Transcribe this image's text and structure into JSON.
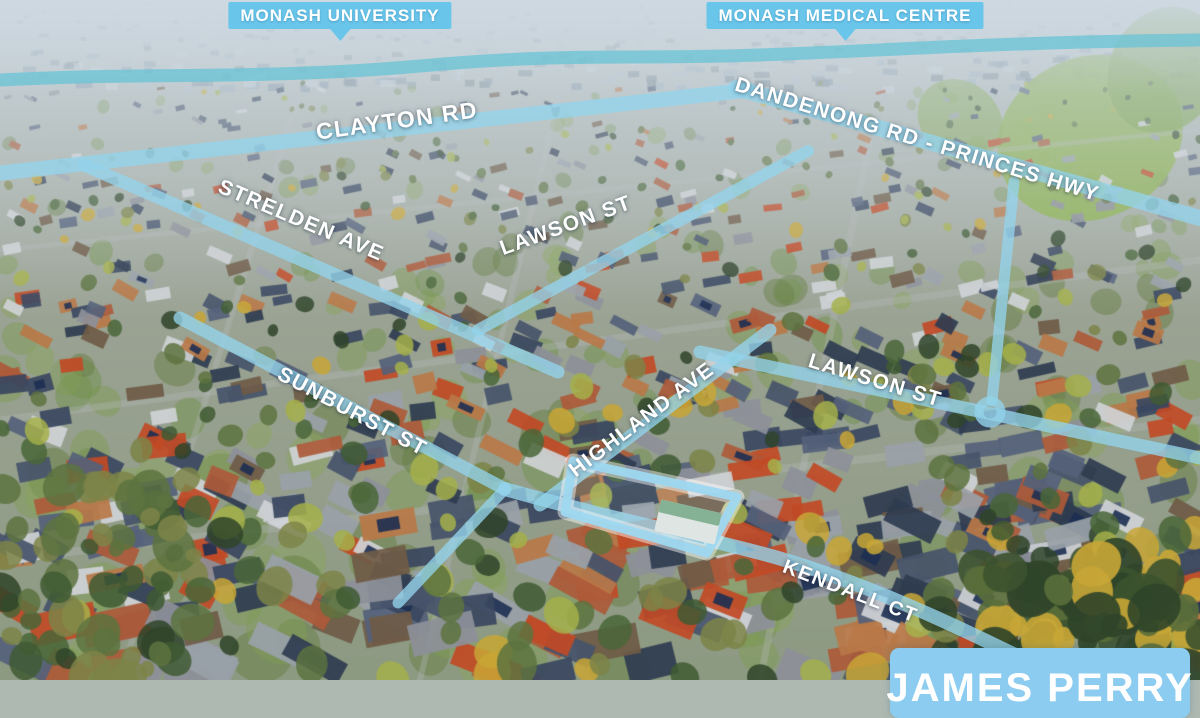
{
  "overlay": {
    "landmarks": [
      {
        "id": "monash-university",
        "label": "MONASH UNIVERSITY"
      },
      {
        "id": "monash-medical-centre",
        "label": "MONASH MEDICAL CENTRE"
      }
    ],
    "streets": [
      {
        "id": "clayton-rd",
        "label": "CLAYTON RD"
      },
      {
        "id": "dandenong-rd",
        "label": "DANDENONG RD - PRINCES HWY"
      },
      {
        "id": "strelden-ave",
        "label": "STRELDEN AVE"
      },
      {
        "id": "lawson-st-west",
        "label": "LAWSON ST"
      },
      {
        "id": "lawson-st-east",
        "label": "LAWSON ST"
      },
      {
        "id": "sunburst-st",
        "label": "SUNBURST ST"
      },
      {
        "id": "highland-ave",
        "label": "HIGHLAND AVE"
      },
      {
        "id": "kendall-ct",
        "label": "KENDALL CT"
      }
    ],
    "brand": {
      "name": "JAMES PERRY"
    },
    "colors": {
      "road_highlight": "#8ed2ee",
      "creek": "#6cc4d6",
      "callout_box": "#69c5ea",
      "brand_box": "#8cccf0",
      "label_text": "#ffffff"
    }
  }
}
